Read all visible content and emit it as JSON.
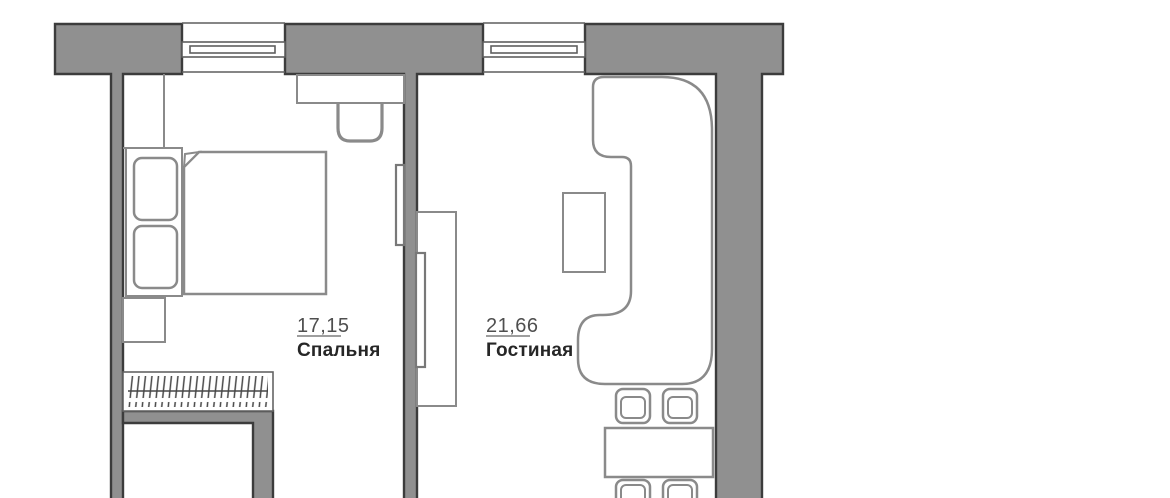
{
  "plan": {
    "type": "apartment-floor-plan",
    "rooms": [
      {
        "name": "Спальня",
        "area": "17,15"
      },
      {
        "name": "Гостиная",
        "area": "21,66"
      }
    ],
    "furniture_symbols": {
      "bedroom": [
        "corner-closet",
        "double-bed",
        "pillows",
        "mattress-with-fold",
        "nightstand",
        "wardrobe-with-hangers",
        "desk",
        "stool",
        "wall-tv"
      ],
      "living_room": [
        "tv-stand",
        "wall-tv",
        "coffee-table",
        "corner-sofa",
        "dining-table",
        "dining-chairs"
      ],
      "shared": [
        "window",
        "load-bearing-wall"
      ]
    }
  },
  "colors": {
    "background": "#ffffff",
    "wall_fill": "#909090",
    "wall_outline": "#3c3c3c",
    "furniture_line": "#8a8a8a",
    "furniture_line_dark": "#787878",
    "window_line": "#5f5f5f",
    "hanger_line": "#474747",
    "area_text": "#4f4f4f",
    "name_text": "#262626",
    "underline": "#9e9e9e"
  }
}
